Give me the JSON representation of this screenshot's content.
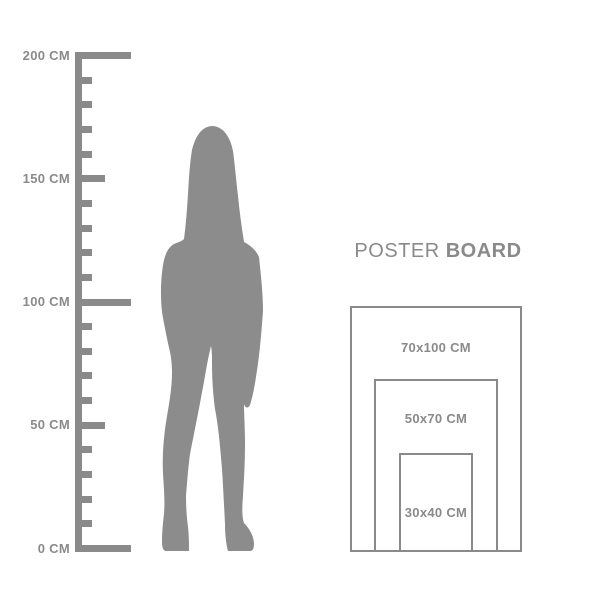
{
  "page": {
    "background": "#ffffff"
  },
  "colors": {
    "gray": "#8a8a8a",
    "silhouette": "#8c8c8c"
  },
  "ruler": {
    "unit": "CM",
    "min_cm": 0,
    "max_cm": 200,
    "tick_step_cm": 10,
    "labeled_ticks": [
      {
        "text": "200 CM",
        "cm": 200
      },
      {
        "text": "150 CM",
        "cm": 150
      },
      {
        "text": "100 CM",
        "cm": 100
      },
      {
        "text": "50 CM",
        "cm": 50
      },
      {
        "text": "0 CM",
        "cm": 0
      }
    ]
  },
  "figure": {
    "description": "standing woman silhouette"
  },
  "poster_board": {
    "title_regular": "POSTER",
    "title_bold": "BOARD",
    "sizes": [
      {
        "label": "70x100 CM",
        "width_cm": 70,
        "height_cm": 100
      },
      {
        "label": "50x70 CM",
        "width_cm": 50,
        "height_cm": 70
      },
      {
        "label": "30x40 CM",
        "width_cm": 30,
        "height_cm": 40
      }
    ]
  }
}
